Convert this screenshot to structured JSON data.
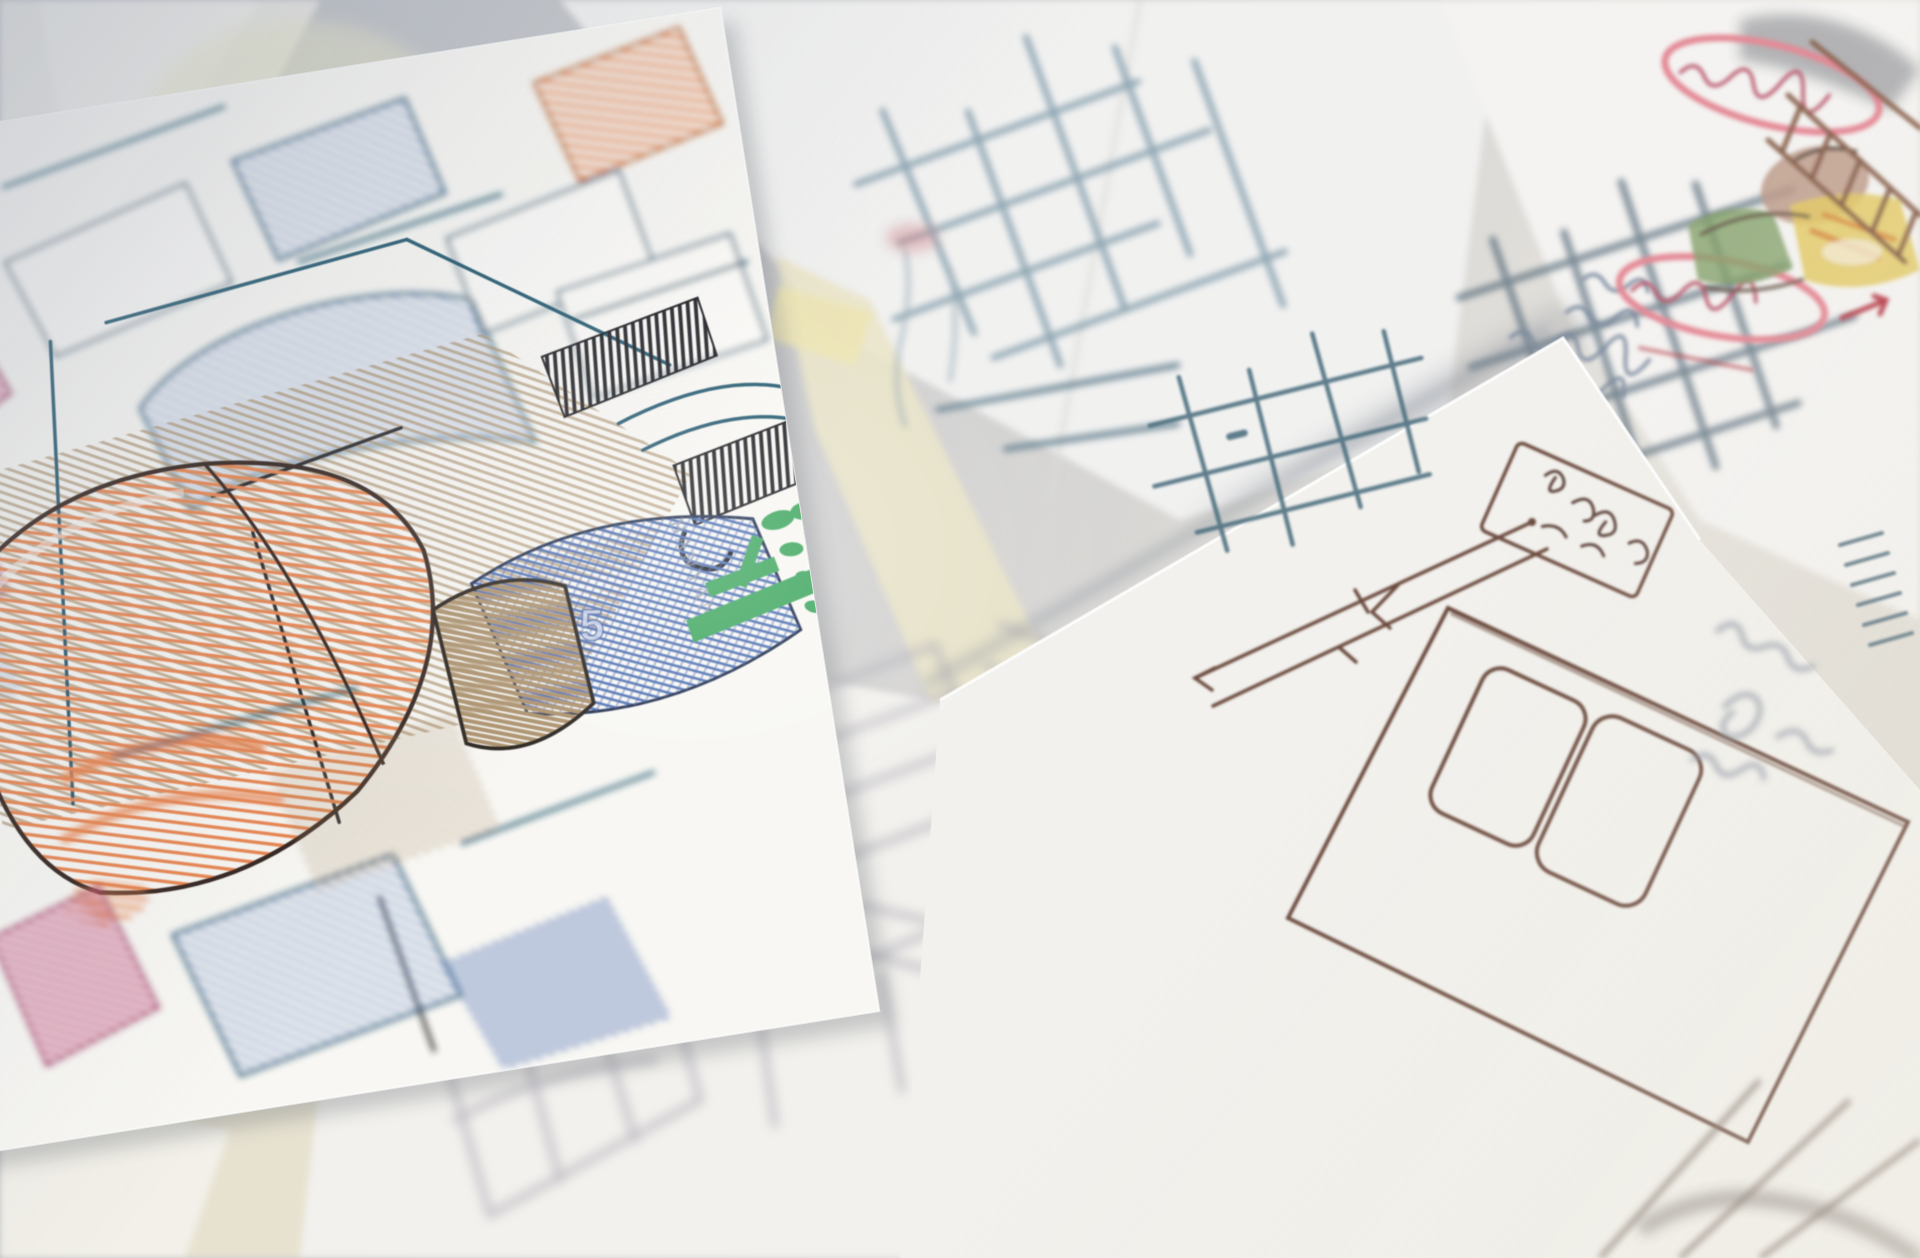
{
  "scene": {
    "type": "photograph",
    "subject": "Desk covered with overlapping hand-drawn furniture design sketch papers",
    "focus": "shallow depth of field, sharp on the colored concept sketch at center-left",
    "elements": [
      "colored-pencil furniture concept sketch with orange cone lamp, blue hatched seats, magenta patches and brown shading",
      "green banyan tree logo with vertical BANYAN watermark",
      "blurred teal pen grid plans on white papers at top",
      "two red oval annotations circling handwritten notes at top right",
      "small watercolor figure sketch and brown ladder grid at top right corner",
      "white sketch paper with brown pen room-plan rectangle, labeled box and dimension arrows at right",
      "very blurred gray pencil wardrobe sketches on foreground papers at bottom",
      "cream and yellow note papers tucked between sheets"
    ]
  },
  "watermark": {
    "brand": "BANYAN"
  },
  "annotations": {
    "sketch_number": "5"
  },
  "colors": {
    "background_top": "#b2b6bf",
    "background_bottom": "#ddd9d1",
    "paper_white": "#f8f7f3",
    "paper_white_2": "#f2f1ed",
    "paper_cream": "#e9e3d1",
    "sticky_yellow": "#ece4b4",
    "pencil_blue": "#7b98cc",
    "pencil_blue_dark": "#4a6cb0",
    "pencil_orange": "#e8834e",
    "pencil_magenta": "#bb3a6e",
    "pencil_brown": "#a88d68",
    "ink_dark": "#1a1c20",
    "pen_teal": "#22586e",
    "sketch_teal_soft": "#7e99a8",
    "pen_brown": "#6b4a3c",
    "logo_green": "#3aa55c",
    "annotation_red": "#e48a96",
    "annotation_red_dark": "#b8556a",
    "figure_yellow": "#e2c968",
    "figure_green": "#86a16b",
    "figure_tan": "#bd9c8b",
    "pencil_gray": "#a9a6b2"
  }
}
